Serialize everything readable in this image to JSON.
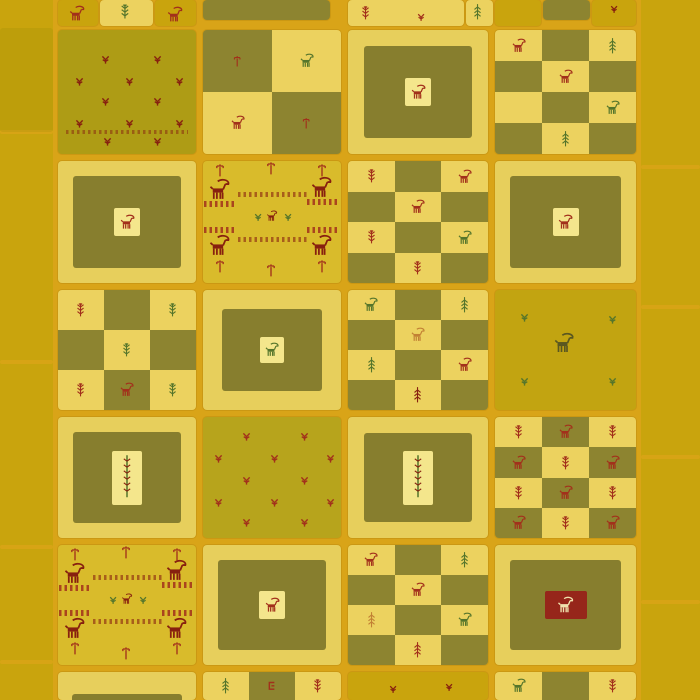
{
  "meta": {
    "subject": "gabbeh-patchwork-rug-product-photo",
    "canvas": {
      "width": 700,
      "height": 700
    }
  },
  "palette": {
    "gold": "#c9a40d",
    "goldField": "#c2a411",
    "grout": "#d9a418",
    "pale": "#ecd25f",
    "paleLight": "#f4e68c",
    "frame": "#e7cf5c",
    "olive": "#8d8430",
    "oliveInner": "#877e2e",
    "scatterOlive": "#ae9c15",
    "scatterPale": "#b7a41c",
    "pictBg": "#d9bb2b",
    "red": "#a2301b",
    "darkRed": "#87200f",
    "green": "#55752b",
    "darkGreen": "#3f6220",
    "orange": "#c28134",
    "cream": "#efe2ad",
    "redBox": "#96261a",
    "inkOlive": "#5a5720",
    "tintOverlay": "rgba(110,115,0,0.12)"
  },
  "rug": {
    "grout_panel": {
      "x": 53,
      "y": 0,
      "w": 590,
      "h": 700
    },
    "left_band": {
      "x": 0,
      "y": 0,
      "w": 53,
      "h": 700,
      "seams": [
        130,
        360,
        545,
        660
      ],
      "tint": {
        "y": 28,
        "h": 104
      }
    },
    "right_band": {
      "x": 641,
      "y": 0,
      "w": 59,
      "h": 700,
      "seams": [
        165,
        305,
        455,
        600
      ]
    },
    "pictorial_layout": {
      "poles": [
        [
          0.08,
          0.02
        ],
        [
          0.45,
          0.0
        ],
        [
          0.82,
          0.02
        ],
        [
          0.08,
          0.8
        ],
        [
          0.45,
          0.84
        ],
        [
          0.82,
          0.8
        ]
      ],
      "ibexes": [
        [
          0.02,
          0.14
        ],
        [
          0.76,
          0.12
        ],
        [
          0.02,
          0.6
        ],
        [
          0.76,
          0.6
        ]
      ],
      "side_bands": [
        [
          0.01,
          0.33,
          0.22
        ],
        [
          0.75,
          0.31,
          0.22
        ],
        [
          0.01,
          0.54,
          0.22
        ],
        [
          0.75,
          0.54,
          0.22
        ]
      ],
      "center_bands": [
        [
          0.25,
          0.25,
          0.5
        ],
        [
          0.25,
          0.62,
          0.5
        ]
      ],
      "center_trio": {
        "sprigs": [
          [
            0.36,
            0.42
          ],
          [
            0.58,
            0.42
          ]
        ],
        "ibex": [
          0.45,
          0.4
        ]
      }
    },
    "cells": [
      {
        "id": "r0-a1",
        "x": 58,
        "y": 0,
        "w": 40,
        "h": 26,
        "type": "plain",
        "bg": "gold",
        "motifs": [
          {
            "k": "ibex",
            "c": "red",
            "x": 9,
            "y": 5,
            "s": 20
          }
        ]
      },
      {
        "id": "r0-a2",
        "x": 100,
        "y": 0,
        "w": 53,
        "h": 26,
        "type": "plain",
        "bg": "pale",
        "motifs": [
          {
            "k": "tree",
            "c": "green",
            "x": 19,
            "y": 2,
            "s": 14
          }
        ]
      },
      {
        "id": "r0-a3",
        "x": 155,
        "y": 0,
        "w": 41,
        "h": 26,
        "type": "plain",
        "bg": "gold",
        "motifs": [
          {
            "k": "ibex",
            "c": "red",
            "x": 10,
            "y": 6,
            "s": 20
          }
        ]
      },
      {
        "id": "r0-b",
        "x": 203,
        "y": 0,
        "w": 127,
        "h": 20,
        "type": "plain",
        "bg": "olive",
        "motifs": []
      },
      {
        "id": "r0-c",
        "x": 348,
        "y": 0,
        "w": 116,
        "h": 26,
        "type": "plain",
        "bg": "pale",
        "motifs": [
          {
            "k": "tree",
            "c": "red",
            "x": 12,
            "y": 4,
            "s": 13
          },
          {
            "k": "sprig",
            "c": "red",
            "x": 68,
            "y": 12,
            "s": 12
          }
        ]
      },
      {
        "id": "r0-c2",
        "x": 466,
        "y": 0,
        "w": 27,
        "h": 26,
        "type": "plain",
        "bg": "pale",
        "motifs": [
          {
            "k": "pine",
            "c": "green",
            "x": 6,
            "y": 2,
            "s": 13
          }
        ]
      },
      {
        "id": "r0-d1",
        "x": 495,
        "y": 0,
        "w": 46,
        "h": 26,
        "type": "plain",
        "bg": "gold",
        "motifs": []
      },
      {
        "id": "r0-d2",
        "x": 543,
        "y": 0,
        "w": 47,
        "h": 20,
        "type": "plain",
        "bg": "olive",
        "motifs": []
      },
      {
        "id": "r0-d3",
        "x": 592,
        "y": 0,
        "w": 44,
        "h": 26,
        "type": "plain",
        "bg": "gold",
        "motifs": [
          {
            "k": "sprig",
            "c": "darkRed",
            "x": 17,
            "y": 4,
            "s": 12
          }
        ]
      },
      {
        "id": "r1-a",
        "x": 58,
        "y": 30,
        "w": 138,
        "h": 124,
        "type": "scatter",
        "bg": "scatterOlive",
        "motifs": [
          {
            "k": "sprig",
            "c": "darkRed",
            "x": 42,
            "y": 24,
            "s": 13
          },
          {
            "k": "sprig",
            "c": "darkRed",
            "x": 94,
            "y": 24,
            "s": 13
          },
          {
            "k": "sprig",
            "c": "darkRed",
            "x": 16,
            "y": 46,
            "s": 13
          },
          {
            "k": "sprig",
            "c": "darkRed",
            "x": 66,
            "y": 46,
            "s": 13
          },
          {
            "k": "sprig",
            "c": "darkRed",
            "x": 116,
            "y": 46,
            "s": 13
          },
          {
            "k": "sprig",
            "c": "darkRed",
            "x": 42,
            "y": 66,
            "s": 13
          },
          {
            "k": "sprig",
            "c": "darkRed",
            "x": 94,
            "y": 66,
            "s": 13
          },
          {
            "k": "sprig",
            "c": "darkRed",
            "x": 16,
            "y": 88,
            "s": 13
          },
          {
            "k": "sprig",
            "c": "darkRed",
            "x": 66,
            "y": 88,
            "s": 13
          },
          {
            "k": "sprig",
            "c": "darkRed",
            "x": 116,
            "y": 88,
            "s": 13
          },
          {
            "k": "sprig",
            "c": "darkRed",
            "x": 44,
            "y": 106,
            "s": 13
          },
          {
            "k": "sprig",
            "c": "darkRed",
            "x": 94,
            "y": 106,
            "s": 13
          }
        ],
        "bands": [
          {
            "x": 8,
            "y": 100,
            "w": 122,
            "h": 4,
            "c": "darkRed",
            "o": 0.5
          }
        ]
      },
      {
        "id": "r1-b",
        "x": 203,
        "y": 30,
        "w": 138,
        "h": 124,
        "type": "checker",
        "rows": [
          [
            "o:pole.red",
            "p:ibex.green"
          ],
          [
            "p:ibex.red",
            "o:pole.red"
          ]
        ]
      },
      {
        "id": "r1-c",
        "x": 348,
        "y": 30,
        "w": 140,
        "h": 124,
        "type": "framed",
        "inset": 16,
        "box": {
          "w": 26,
          "h": 28,
          "bg": "paleLight",
          "motif": {
            "k": "ibex",
            "c": "red",
            "s": 19
          }
        }
      },
      {
        "id": "r1-d",
        "x": 495,
        "y": 30,
        "w": 141,
        "h": 124,
        "type": "checker",
        "rows": [
          [
            "p:ibex.red",
            "o",
            "p:pine.green"
          ],
          [
            "o",
            "p:ibex.red",
            "o"
          ],
          [
            "p",
            "o",
            "p:ibex.green"
          ],
          [
            "o",
            "p:pine.green",
            "o"
          ]
        ]
      },
      {
        "id": "r2-a",
        "x": 58,
        "y": 161,
        "w": 138,
        "h": 122,
        "type": "framed",
        "inset": 15,
        "box": {
          "w": 26,
          "h": 28,
          "bg": "paleLight",
          "motif": {
            "k": "ibex",
            "c": "red",
            "s": 19
          }
        }
      },
      {
        "id": "r2-b",
        "x": 203,
        "y": 161,
        "w": 138,
        "h": 122,
        "type": "pictorial"
      },
      {
        "id": "r2-c",
        "x": 348,
        "y": 161,
        "w": 140,
        "h": 122,
        "type": "checker",
        "rows": [
          [
            "p:tree.red",
            "o",
            "p:ibex.red"
          ],
          [
            "o",
            "p:ibex.red",
            "o"
          ],
          [
            "p:tree.red",
            "o",
            "p:ibex.green"
          ],
          [
            "o",
            "p:tree.red",
            "o"
          ]
        ]
      },
      {
        "id": "r2-d",
        "x": 495,
        "y": 161,
        "w": 141,
        "h": 122,
        "type": "framed",
        "inset": 15,
        "box": {
          "w": 26,
          "h": 28,
          "bg": "paleLight",
          "motif": {
            "k": "ibex",
            "c": "red",
            "s": 19
          }
        }
      },
      {
        "id": "r3-a",
        "x": 58,
        "y": 290,
        "w": 138,
        "h": 120,
        "type": "checker",
        "rows": [
          [
            "p:tree.red",
            "o",
            "p:tree.green"
          ],
          [
            "o",
            "p:tree.green",
            "o"
          ],
          [
            "p:tree.red",
            "o:ibex.red",
            "p:tree.green"
          ]
        ]
      },
      {
        "id": "r3-b",
        "x": 203,
        "y": 290,
        "w": 138,
        "h": 120,
        "type": "framed",
        "inset": 19,
        "box": {
          "w": 24,
          "h": 26,
          "bg": "paleLight",
          "motif": {
            "k": "ibex",
            "c": "green",
            "s": 18
          }
        }
      },
      {
        "id": "r3-c",
        "x": 348,
        "y": 290,
        "w": 140,
        "h": 120,
        "type": "checker",
        "rows": [
          [
            "p:ibex.green",
            "o",
            "p:pine.green"
          ],
          [
            "o",
            "p:ibex.orange",
            "o"
          ],
          [
            "p:pine.green",
            "o",
            "p:ibex.red"
          ],
          [
            "o",
            "p:pine.darkRed",
            "o"
          ]
        ]
      },
      {
        "id": "r3-d",
        "x": 495,
        "y": 290,
        "w": 141,
        "h": 120,
        "type": "scatter",
        "bg": "goldField",
        "motifs": [
          {
            "k": "sprig",
            "c": "green",
            "x": 24,
            "y": 22,
            "s": 13
          },
          {
            "k": "sprig",
            "c": "green",
            "x": 112,
            "y": 24,
            "s": 13
          },
          {
            "k": "ibex",
            "c": "inkOlive",
            "x": 56,
            "y": 42,
            "s": 26
          },
          {
            "k": "sprig",
            "c": "green",
            "x": 24,
            "y": 86,
            "s": 13
          },
          {
            "k": "sprig",
            "c": "green",
            "x": 112,
            "y": 86,
            "s": 13
          }
        ],
        "bands": []
      },
      {
        "id": "r4-a",
        "x": 58,
        "y": 417,
        "w": 138,
        "h": 121,
        "type": "framed",
        "inset": 15,
        "box": {
          "w": 30,
          "h": 54,
          "bg": "paleLight",
          "motif": {
            "k": "treetall",
            "c": "green",
            "s": 28
          }
        }
      },
      {
        "id": "r4-b",
        "x": 203,
        "y": 417,
        "w": 138,
        "h": 121,
        "type": "scatter",
        "bg": "scatterPale",
        "motifs": [
          {
            "k": "sprig",
            "c": "red",
            "x": 38,
            "y": 14,
            "s": 13
          },
          {
            "k": "sprig",
            "c": "red",
            "x": 96,
            "y": 14,
            "s": 13
          },
          {
            "k": "sprig",
            "c": "red",
            "x": 10,
            "y": 36,
            "s": 13
          },
          {
            "k": "sprig",
            "c": "red",
            "x": 66,
            "y": 36,
            "s": 13
          },
          {
            "k": "sprig",
            "c": "red",
            "x": 122,
            "y": 36,
            "s": 13
          },
          {
            "k": "sprig",
            "c": "red",
            "x": 38,
            "y": 58,
            "s": 13
          },
          {
            "k": "sprig",
            "c": "red",
            "x": 96,
            "y": 58,
            "s": 13
          },
          {
            "k": "sprig",
            "c": "red",
            "x": 10,
            "y": 80,
            "s": 13
          },
          {
            "k": "sprig",
            "c": "red",
            "x": 66,
            "y": 80,
            "s": 13
          },
          {
            "k": "sprig",
            "c": "red",
            "x": 122,
            "y": 80,
            "s": 13
          },
          {
            "k": "sprig",
            "c": "red",
            "x": 38,
            "y": 100,
            "s": 13
          },
          {
            "k": "sprig",
            "c": "red",
            "x": 96,
            "y": 100,
            "s": 13
          }
        ],
        "bands": []
      },
      {
        "id": "r4-c",
        "x": 348,
        "y": 417,
        "w": 140,
        "h": 121,
        "type": "framed",
        "inset": 16,
        "box": {
          "w": 30,
          "h": 54,
          "bg": "paleLight",
          "motif": {
            "k": "treetall",
            "c": "green",
            "s": 28
          }
        }
      },
      {
        "id": "r4-d",
        "x": 495,
        "y": 417,
        "w": 141,
        "h": 121,
        "type": "checker",
        "rows": [
          [
            "p:tree.red",
            "o:ibex.red",
            "p:tree.red"
          ],
          [
            "o:ibex.red",
            "p:tree.red",
            "o:ibex.red"
          ],
          [
            "p:tree.red",
            "o:ibex.red",
            "p:tree.red"
          ],
          [
            "o:ibex.red",
            "p:tree.red",
            "o:ibex.red"
          ]
        ]
      },
      {
        "id": "r5-a",
        "x": 58,
        "y": 545,
        "w": 138,
        "h": 120,
        "type": "pictorial"
      },
      {
        "id": "r5-b",
        "x": 203,
        "y": 545,
        "w": 138,
        "h": 120,
        "type": "framed",
        "inset": 15,
        "box": {
          "w": 26,
          "h": 28,
          "bg": "paleLight",
          "motif": {
            "k": "ibex",
            "c": "red",
            "s": 19
          }
        }
      },
      {
        "id": "r5-c",
        "x": 348,
        "y": 545,
        "w": 140,
        "h": 120,
        "type": "checker",
        "rows": [
          [
            "p:ibex.red",
            "o",
            "p:pine.green"
          ],
          [
            "o",
            "p:ibex.red",
            "o"
          ],
          [
            "p:pine.orange",
            "o",
            "p:ibex.green"
          ],
          [
            "o",
            "p:pine.red",
            "o"
          ]
        ]
      },
      {
        "id": "r5-d",
        "x": 495,
        "y": 545,
        "w": 141,
        "h": 120,
        "type": "framed",
        "inset": 15,
        "box": {
          "w": 42,
          "h": 28,
          "bg": "redBox",
          "motif": {
            "k": "ibex",
            "c": "cream",
            "s": 21
          }
        }
      },
      {
        "id": "r6-a",
        "x": 58,
        "y": 672,
        "w": 138,
        "h": 28,
        "type": "frameTop"
      },
      {
        "id": "r6-b",
        "x": 203,
        "y": 672,
        "w": 138,
        "h": 28,
        "type": "checker",
        "rows": [
          [
            "p:pine.green",
            "o:hook.red",
            "p:tree.red"
          ]
        ]
      },
      {
        "id": "r6-c",
        "x": 348,
        "y": 672,
        "w": 140,
        "h": 28,
        "type": "plain",
        "bg": "gold",
        "motifs": [
          {
            "k": "sprig",
            "c": "darkRed",
            "x": 40,
            "y": 12,
            "s": 12
          },
          {
            "k": "sprig",
            "c": "darkRed",
            "x": 96,
            "y": 10,
            "s": 12
          }
        ]
      },
      {
        "id": "r6-d",
        "x": 495,
        "y": 672,
        "w": 141,
        "h": 28,
        "type": "checker",
        "rows": [
          [
            "p:ibex.green",
            "o",
            "p:tree.red"
          ]
        ]
      }
    ]
  }
}
